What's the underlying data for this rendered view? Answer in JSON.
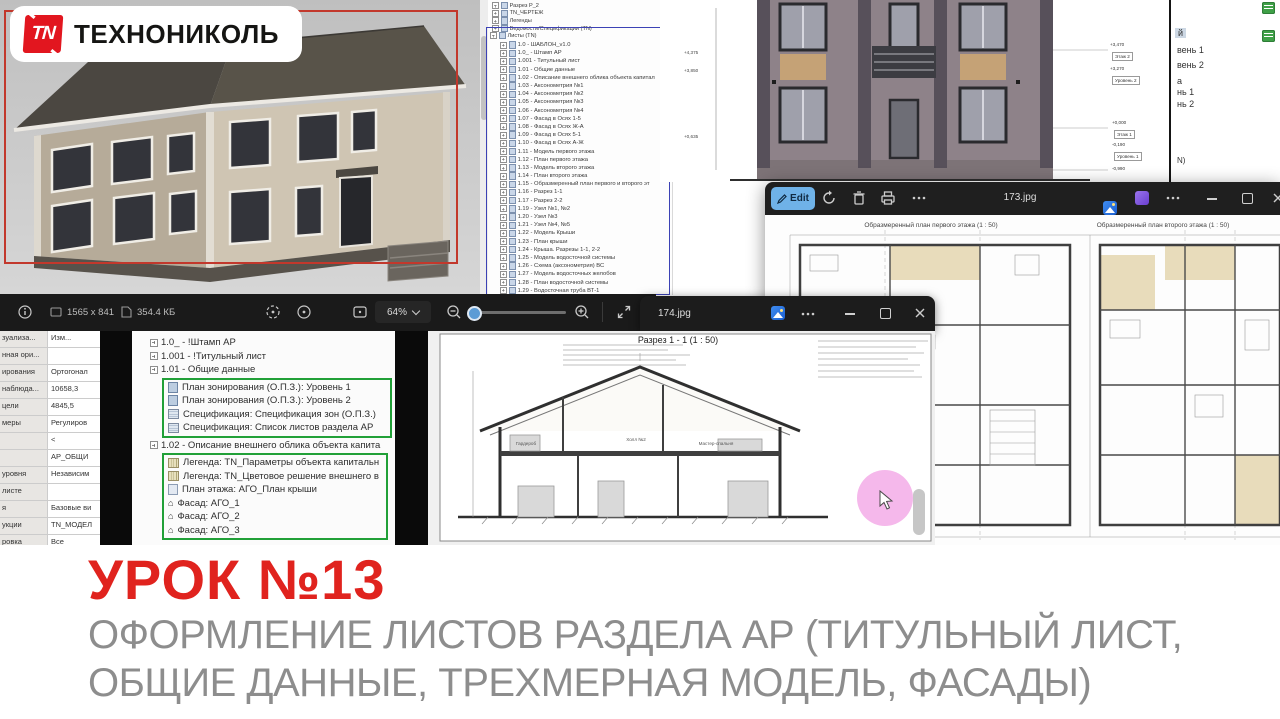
{
  "logo": {
    "tn": "TN",
    "text": "ТЕХНОНИКОЛЬ"
  },
  "lesson": {
    "title": "УРОК №13",
    "subtitle1": "ОФОРМЛЕНИЕ ЛИСТОВ РАЗДЕЛА АР (ТИТУЛЬНЫЙ ЛИСТ,",
    "subtitle2": "ОБЩИЕ ДАННЫЕ, ТРЕХМЕРНАЯ МОДЕЛЬ, ФАСАДЫ)"
  },
  "colors": {
    "brand_red": "#e0231e",
    "edit_blue": "#6fb2e8",
    "green_box": "#21a038",
    "blue_box": "#3c42b5"
  },
  "browser": {
    "top_items": [
      "Разрез Р_2",
      "TN_ЧЕРТЕЖ",
      "Легенды",
      "Ведомости/Спецификации (TN)"
    ],
    "sheets_label": "Листы (TN)",
    "sheets": [
      "1.0 - ШАБЛОН_v1.0",
      "1.0_ - Штамп АР",
      "1.001 - Титульный лист",
      "1.01 - Общие данные",
      "1.02 - Описание внешнего облика объекта капитал",
      "1.03 - Аксонометрия №1",
      "1.04 - Аксонометрия №2",
      "1.05 - Аксонометрия №3",
      "1.06 - Аксонометрия №4",
      "1.07 - Фасад в Осях 1-5",
      "1.08 - Фасад в Осях Ж-А",
      "1.09 - Фасад в Осях 5-1",
      "1.10 - Фасад в Осях А-Ж",
      "1.11 - Модель первого этажа",
      "1.12 - План первого этажа",
      "1.13 - Модель второго этажа",
      "1.14 - План второго этажа",
      "1.15 - Образмеренный план первого и второго эт",
      "1.16 - Разрез 1-1",
      "1.17 - Разрез 2-2",
      "1.19 - Узел №1, №2",
      "1.20 - Узел №3",
      "1.21 - Узел №4, №5",
      "1.22 - Модель Крыши",
      "1.23 - План крыши",
      "1.24 - Крыша. Разрезы 1-1, 2-2",
      "1.25 - Модель водосточной системы",
      "1.26 - Схема (аксонометрия) ВС",
      "1.27 - Модель водосточных желобов",
      "1.28 - План водосточной системы",
      "1.29 - Водосточная труба ВТ-1"
    ]
  },
  "zoom_browser": {
    "rows_top": [
      "1.0_ - !Штамп АР",
      "1.001 - !Титульный лист",
      "1.01 - Общие данные"
    ],
    "group1": [
      "План зонирования (О.П.З.): Уровень 1",
      "План зонирования (О.П.З.): Уровень 2",
      "Спецификация: Спецификация зон (О.П.З.)",
      "Спецификация: Список листов раздела АР"
    ],
    "row_mid": "1.02 - Описание внешнего облика объекта капита",
    "group2": [
      "Легенда: TN_Параметры объекта капитальн",
      "Легенда: TN_Цветовое решение внешнего в",
      "План этажа: АГО_План крыши",
      "Фасад: АГО_1",
      "Фасад: АГО_2",
      "Фасад: АГО_3"
    ]
  },
  "properties": {
    "rows": [
      {
        "label": "зуализа...",
        "value": "Изм..."
      },
      {
        "label": "нная ори...",
        "value": ""
      },
      {
        "label": "ирования",
        "value": "Ортогонал"
      },
      {
        "label": "наблюда...",
        "value": "10658,3"
      },
      {
        "label": "цели",
        "value": "4845,5"
      },
      {
        "label": "меры",
        "value": "Регулиров"
      },
      {
        "label": "",
        "value": "<"
      },
      {
        "label": "",
        "value": "АР_ОБЩИ"
      },
      {
        "label": "уровня",
        "value": "Независим"
      },
      {
        "label": "листе",
        "value": ""
      },
      {
        "label": "я",
        "value": "Базовые ви"
      },
      {
        "label": "укции",
        "value": "TN_МОДЕЛ"
      },
      {
        "label": "ровка",
        "value": "Все"
      }
    ]
  },
  "viewer_toolbar": {
    "dimensions": "1565 x 841",
    "file_size": "354.4 КБ",
    "zoom_level": "64%"
  },
  "window_173": {
    "title": "173.jpg",
    "edit_label": "Edit"
  },
  "window_174": {
    "title": "174.jpg"
  },
  "plans": {
    "title_left": "Образмеренный план первого этажа (1 : 50)",
    "title_right": "Образмеренный план второго этажа (1 : 50)"
  },
  "section": {
    "title": "Разрез 1 - 1 (1 : 50)",
    "rooms": [
      "Гардероб",
      "Холл №2",
      "Мастер-спальня"
    ]
  },
  "facade": {
    "dims_left": [
      "+4,375",
      "+3,850",
      "+0,635"
    ],
    "levels": [
      {
        "elev": "+3,470",
        "name": "Этаж 2"
      },
      {
        "elev": "+3,270",
        "name": "Уровень 2"
      },
      {
        "elev": "+0,000",
        "name": "Этаж 1"
      },
      {
        "elev": "-0,190",
        "name": "Уровень 1"
      },
      {
        "elev": "-0,990",
        "name": ""
      }
    ]
  },
  "right_panel": {
    "items": [
      "й",
      "вень 1",
      "вень 2",
      "а",
      "нь 1",
      "нь 2",
      "N)"
    ]
  }
}
